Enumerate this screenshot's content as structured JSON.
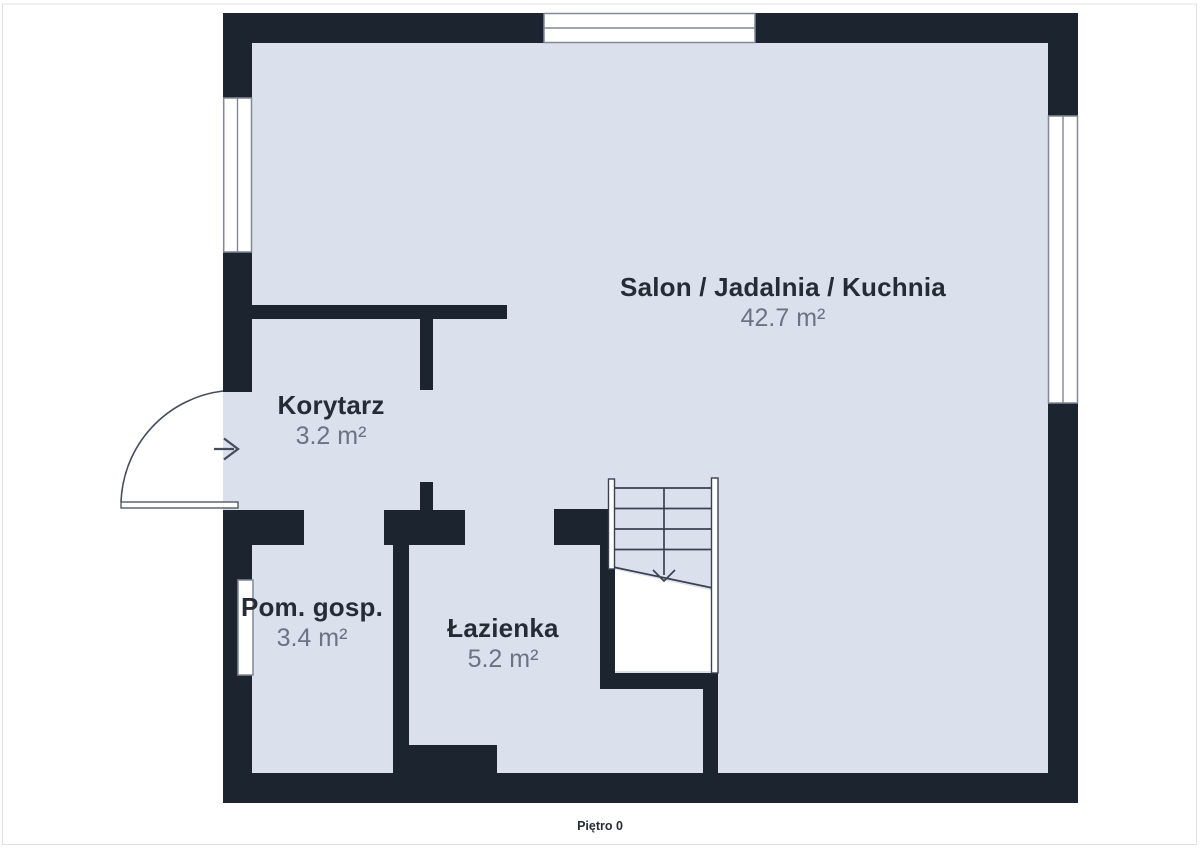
{
  "floor_label": "Piętro 0",
  "rooms": {
    "salon": {
      "name": "Salon / Jadalnia / Kuchnia",
      "area": "42.7 m²"
    },
    "korytarz": {
      "name": "Korytarz",
      "area": "3.2 m²"
    },
    "pom_gosp": {
      "name": "Pom. gosp.",
      "area": "3.4 m²"
    },
    "lazienka": {
      "name": "Łazienka",
      "area": "5.2 m²"
    }
  },
  "colors": {
    "background": "#ffffff",
    "wall": "#1c2430",
    "floor": "#dbe1ec",
    "room_name": "#262c36",
    "room_area": "#6b7380",
    "window_outline": "#808995",
    "stair_line": "#3a4150",
    "door_line": "#454d5a",
    "frame_line": "#e0e0e0"
  }
}
